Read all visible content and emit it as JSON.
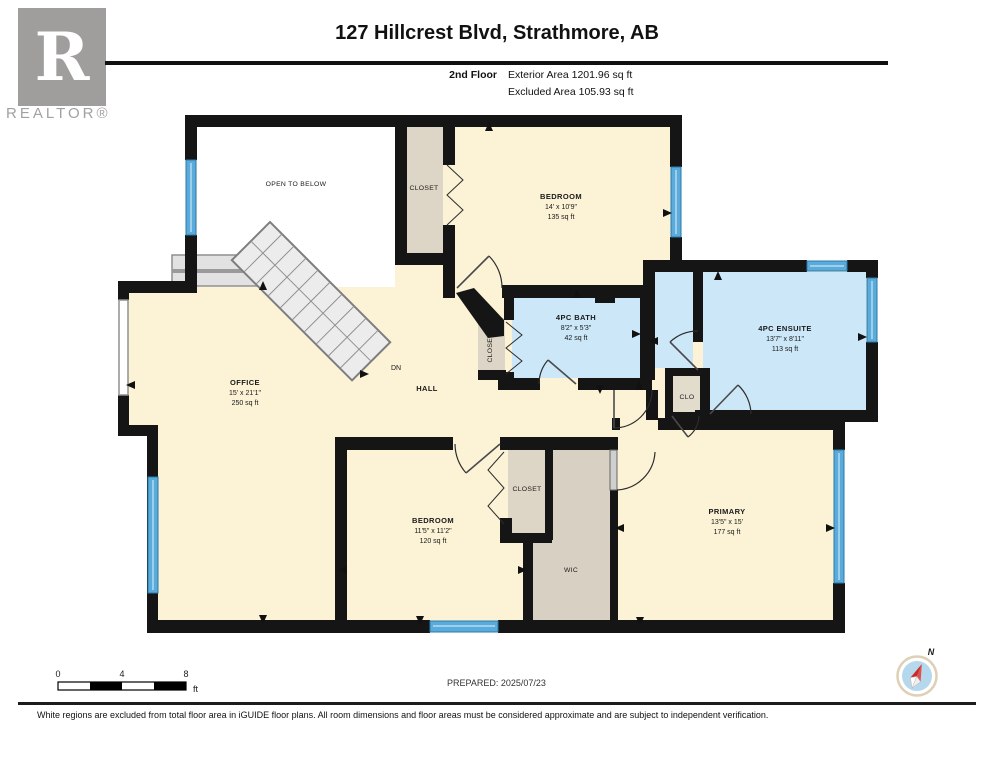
{
  "header": {
    "logo_letter": "R",
    "logo_wordmark": "REALTOR®",
    "title": "127 Hillcrest Blvd, Strathmore, AB",
    "floor_label": "2nd Floor",
    "exterior_area": "Exterior Area 1201.96 sq ft",
    "excluded_area": "Excluded Area 105.93 sq ft"
  },
  "rooms": {
    "open_to_below": {
      "name": "OPEN TO BELOW"
    },
    "closet_top": {
      "name": "CLOSET"
    },
    "bedroom_top": {
      "name": "BEDROOM",
      "dims": "14' x 10'9\"",
      "area": "135 sq ft"
    },
    "bath": {
      "name": "4PC BATH",
      "dims": "8'2\" x 5'3\"",
      "area": "42 sq ft"
    },
    "ensuite": {
      "name": "4PC ENSUITE",
      "dims": "13'7\" x 8'11\"",
      "area": "113 sq ft"
    },
    "office": {
      "name": "OFFICE",
      "dims": "15' x 21'1\"",
      "area": "250 sq ft"
    },
    "hall": {
      "name": "HALL"
    },
    "stairs_label": "DN",
    "closet_mid": {
      "name": "CLOSET"
    },
    "clo": {
      "name": "CLO"
    },
    "bedroom_bottom": {
      "name": "BEDROOM",
      "dims": "11'5\" x 11'2\"",
      "area": "120 sq ft"
    },
    "closet_bottom": {
      "name": "CLOSET"
    },
    "wic": {
      "name": "WIC"
    },
    "primary": {
      "name": "PRIMARY",
      "dims": "13'5\" x 15'",
      "area": "177 sq ft"
    }
  },
  "scale_bar": {
    "start": "0",
    "mid": "4",
    "end": "8",
    "unit": "ft"
  },
  "compass": {
    "north": "N"
  },
  "footer": {
    "prepared": "PREPARED: 2025/07/23",
    "disclaimer": "White regions are excluded from total floor area in iGUIDE floor plans. All room dimensions and floor areas must be considered approximate and are subject to independent verification."
  },
  "colors": {
    "room_fill": "#fcf2d6",
    "wet_room_fill": "#cce7f8",
    "closet_fill": "#ddd5c5",
    "wall": "#151515",
    "window": "#5aabdb"
  }
}
